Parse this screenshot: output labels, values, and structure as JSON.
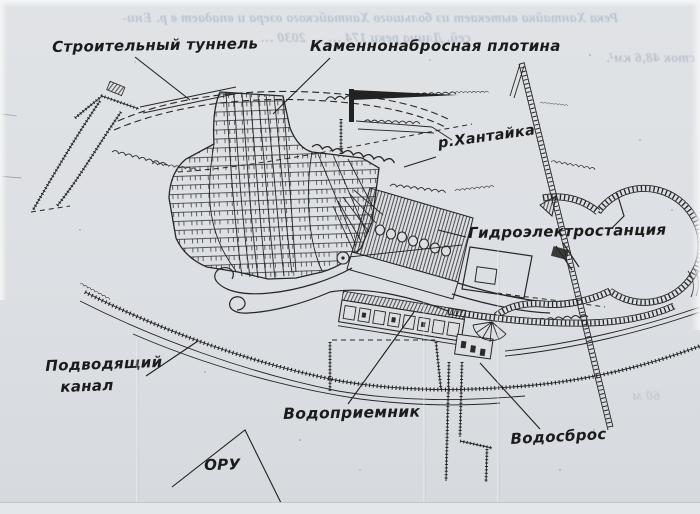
{
  "colors": {
    "paper": "#dcdfe2",
    "ink": "#262626",
    "bleed": "#8d9ab2"
  },
  "labels": {
    "construction_tunnel": "Строительный туннель",
    "rockfill_dam": "Каменнонабросная плотина",
    "river": "р.Хантайка",
    "power_station": "Гидроэлектростанция",
    "supply_channel_line1": "Подводящий",
    "supply_channel_line2": "канал",
    "water_intake": "Водоприемник",
    "spillway": "Водосброс",
    "switchyard": "ОРУ"
  },
  "bleed_through": {
    "line1": "Река Хантайка вытекает из большого Хантайского озера и впадает в р. Ени-",
    "line2": "сей. Длина реки 174 …  … 2030 …",
    "line3": "сток 48,6 км².",
    "fragment": "60 м"
  }
}
